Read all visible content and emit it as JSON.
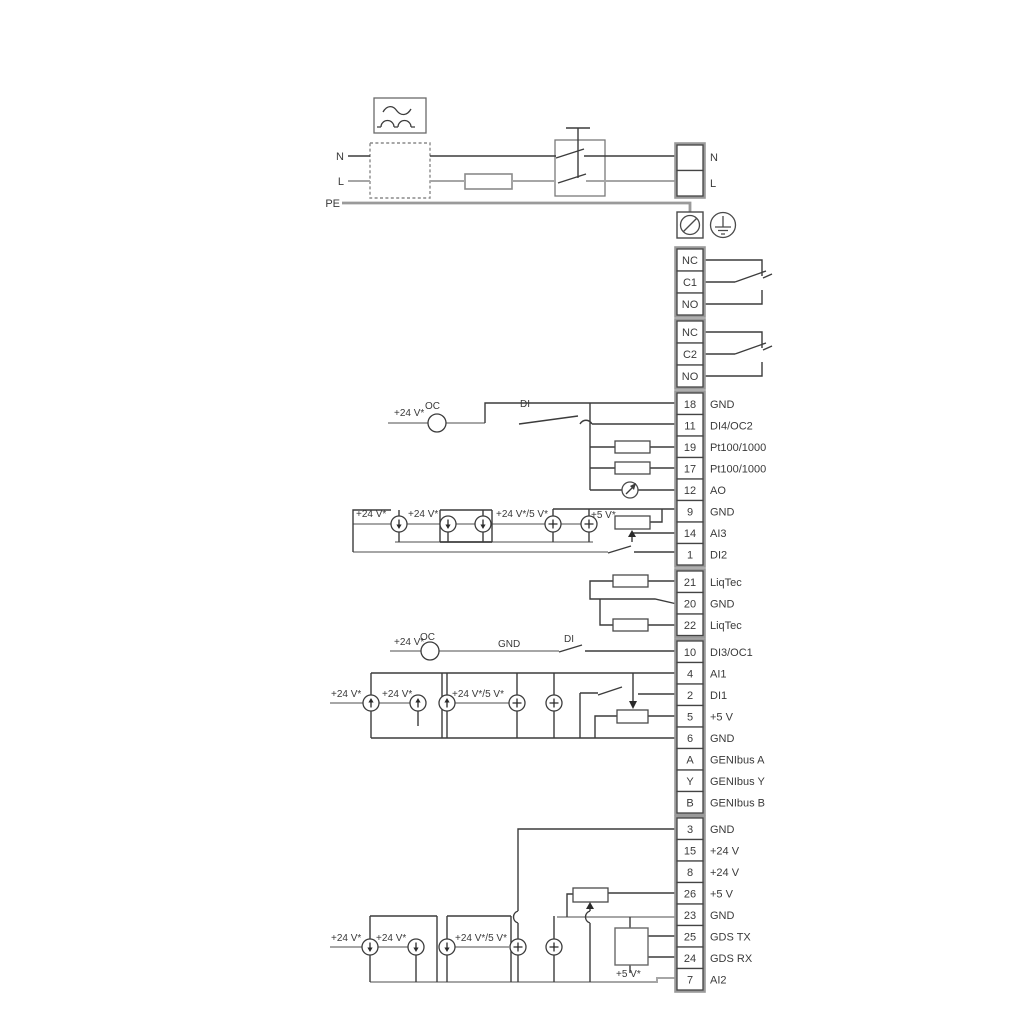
{
  "labels": {
    "n_in": "N",
    "l_in": "L",
    "pe": "PE",
    "n_out": "N",
    "l_out": "L"
  },
  "relays": [
    {
      "terminals": [
        "NC",
        "C1",
        "NO"
      ]
    },
    {
      "terminals": [
        "NC",
        "C2",
        "NO"
      ]
    }
  ],
  "terminals": {
    "rows": [
      {
        "id": "18",
        "label": "GND"
      },
      {
        "id": "11",
        "label": "DI4/OC2"
      },
      {
        "id": "19",
        "label": "Pt100/1000"
      },
      {
        "id": "17",
        "label": "Pt100/1000"
      },
      {
        "id": "12",
        "label": "AO"
      },
      {
        "id": "9",
        "label": "GND"
      },
      {
        "id": "14",
        "label": "AI3"
      },
      {
        "id": "1",
        "label": "DI2"
      },
      {
        "id": "21",
        "label": "LiqTec"
      },
      {
        "id": "20",
        "label": "GND"
      },
      {
        "id": "22",
        "label": "LiqTec"
      },
      {
        "id": "10",
        "label": "DI3/OC1"
      },
      {
        "id": "4",
        "label": "AI1"
      },
      {
        "id": "2",
        "label": "DI1"
      },
      {
        "id": "5",
        "label": "+5 V"
      },
      {
        "id": "6",
        "label": "GND"
      },
      {
        "id": "A",
        "label": "GENIbus A"
      },
      {
        "id": "Y",
        "label": "GENIbus Y"
      },
      {
        "id": "B",
        "label": "GENIbus B"
      },
      {
        "id": "3",
        "label": "GND"
      },
      {
        "id": "15",
        "label": "+24 V"
      },
      {
        "id": "8",
        "label": "+24 V"
      },
      {
        "id": "26",
        "label": "+5 V"
      },
      {
        "id": "23",
        "label": "GND"
      },
      {
        "id": "25",
        "label": "GDS TX"
      },
      {
        "id": "24",
        "label": "GDS RX"
      },
      {
        "id": "7",
        "label": "AI2"
      }
    ]
  },
  "annotations": {
    "v24": "+24 V*",
    "v24_5": "+24 V*/5 V*",
    "v5": "+5 V*",
    "oc": "OC",
    "di": "DI",
    "gnd": "GND"
  },
  "colors": {
    "wire_dark": "#3c3c3c",
    "wire_gray": "#a6a6a6",
    "outline_gray": "#9a9a9a",
    "background": "#ffffff"
  }
}
